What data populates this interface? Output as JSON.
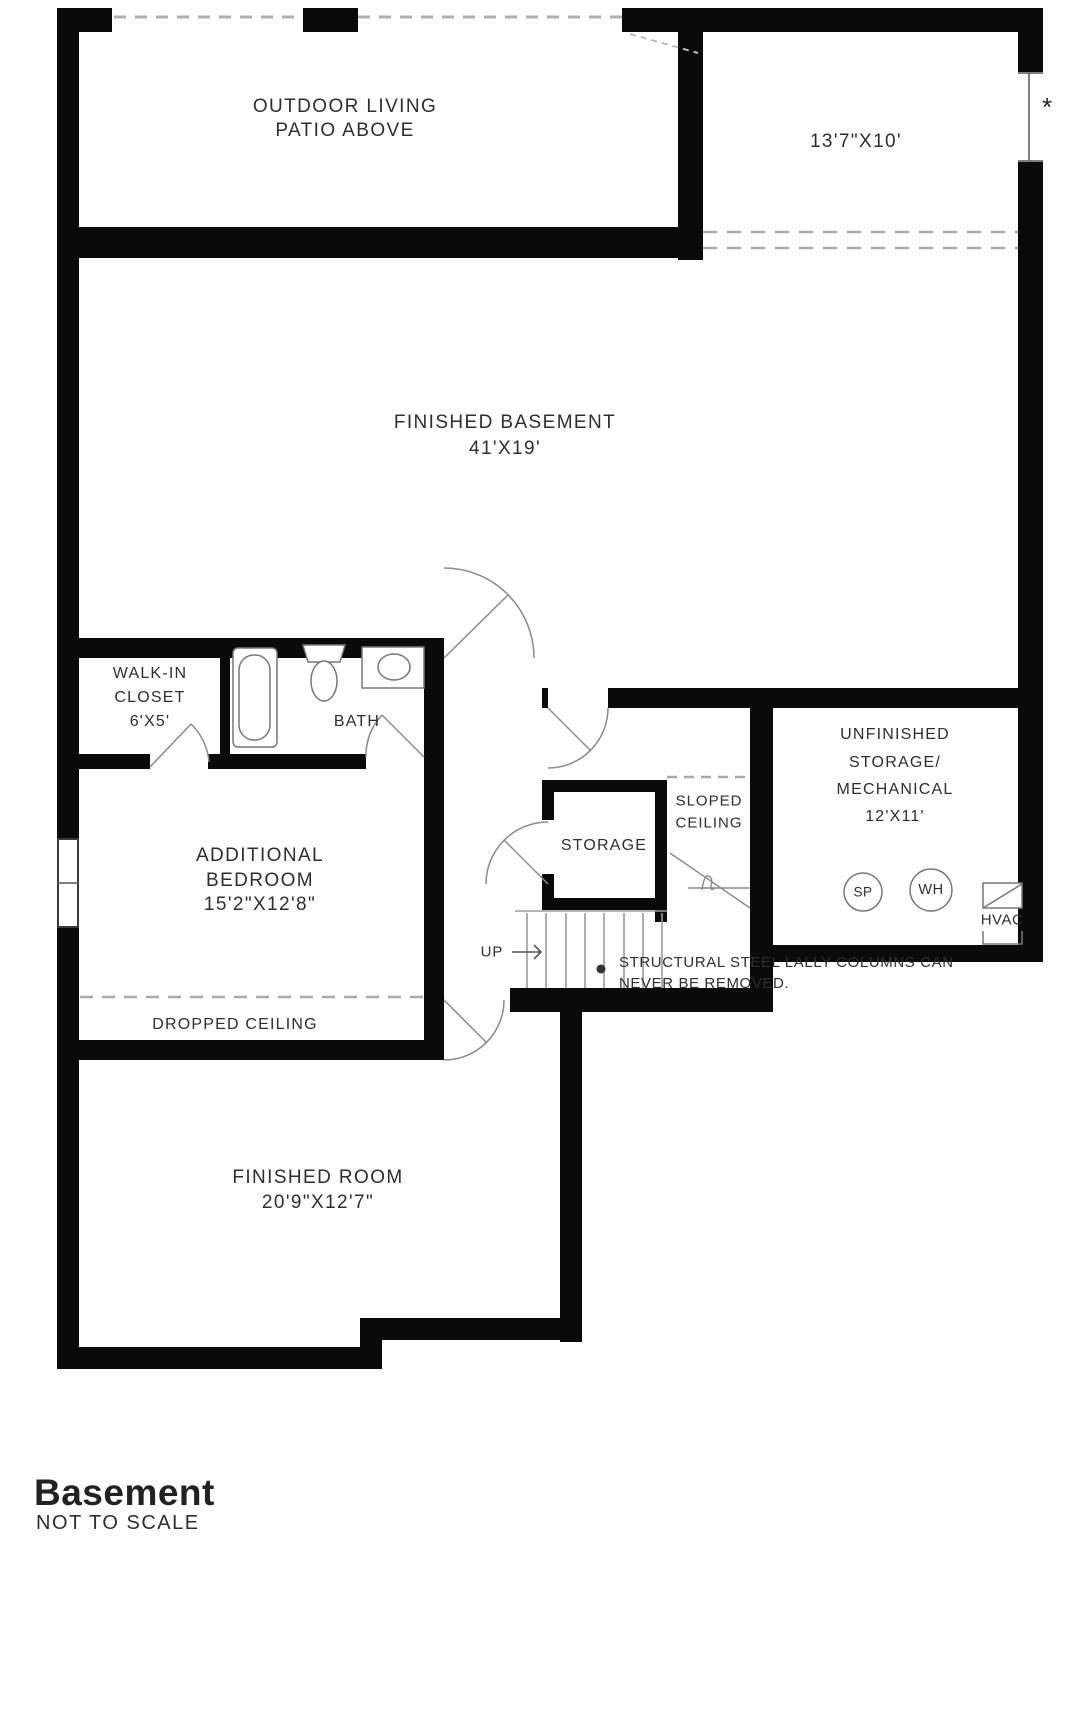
{
  "labels": {
    "patio": [
      "OUTDOOR LIVING",
      "PATIO ABOVE"
    ],
    "alcove_dim": "13'7\"X10'",
    "asterisk": "*",
    "basement": [
      "FINISHED BASEMENT",
      "41'X19'"
    ],
    "closet": [
      "WALK-IN",
      "CLOSET",
      "6'X5'"
    ],
    "bath": "BATH",
    "bedroom": [
      "ADDITIONAL",
      "BEDROOM",
      "15'2\"X12'8\""
    ],
    "dropped_ceiling": "DROPPED CEILING",
    "storage": "STORAGE",
    "sloped_ceiling": [
      "SLOPED",
      "CEILING"
    ],
    "unfinished": [
      "UNFINISHED",
      "STORAGE/",
      "MECHANICAL",
      "12'X11'"
    ],
    "up": "UP",
    "sp": "SP",
    "wh": "WH",
    "hvac": "HVAC",
    "finished_room": [
      "FINISHED ROOM",
      "20'9\"X12'7\""
    ],
    "note": [
      "STRUCTURAL STEEL LALLY COLUMNS CAN",
      "NEVER BE REMOVED."
    ]
  },
  "footer": {
    "title": "Basement",
    "subtitle": "NOT TO SCALE"
  },
  "colors": {
    "wall": "#0a0a0a",
    "text": "#2e2e2e",
    "thin_line": "#8a8a8a",
    "dashed": "#b0b0b0"
  }
}
